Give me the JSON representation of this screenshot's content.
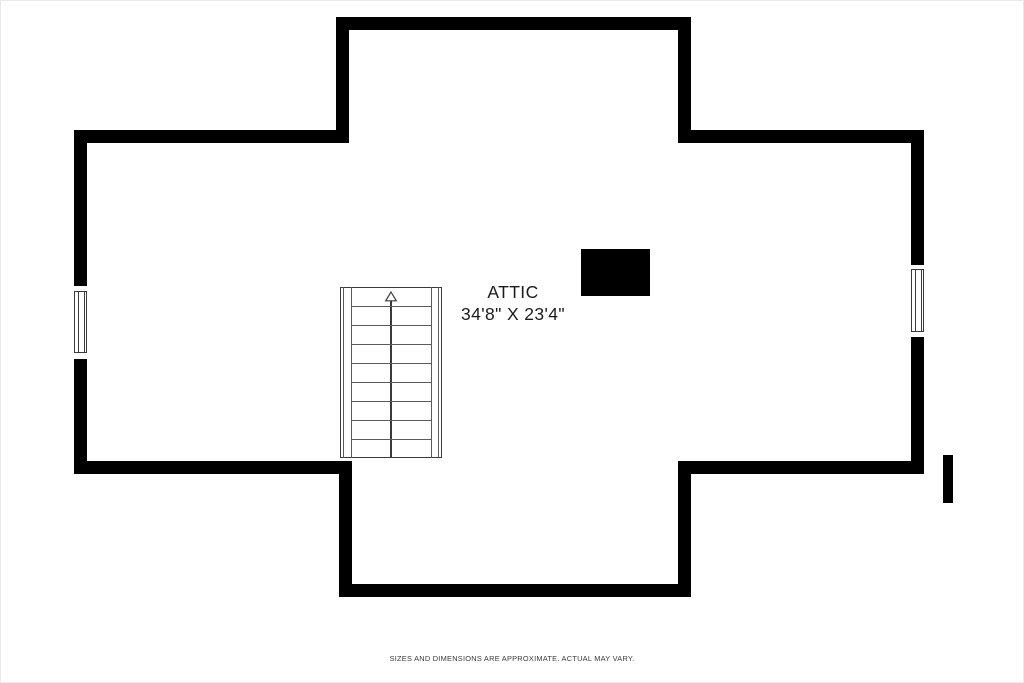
{
  "plan": {
    "room": {
      "name": "ATTIC",
      "dimensions": "34'8\" X 23'4\""
    },
    "stairs": {
      "icon": "up-arrow-icon",
      "direction": "up"
    },
    "footer": {
      "disclaimer": "SIZES AND DIMENSIONS ARE APPROXIMATE. ACTUAL MAY VARY."
    }
  },
  "colors": {
    "background": "#ffffff",
    "page_border": "#eaeaea",
    "wall": "#000000",
    "label_text": "#1c1c1c",
    "disclaimer_text": "#3a3a3a",
    "stair_line": "#3a3a3a",
    "stair_line_soft": "#5b5b5b",
    "window_line": "#3a3a3a"
  }
}
